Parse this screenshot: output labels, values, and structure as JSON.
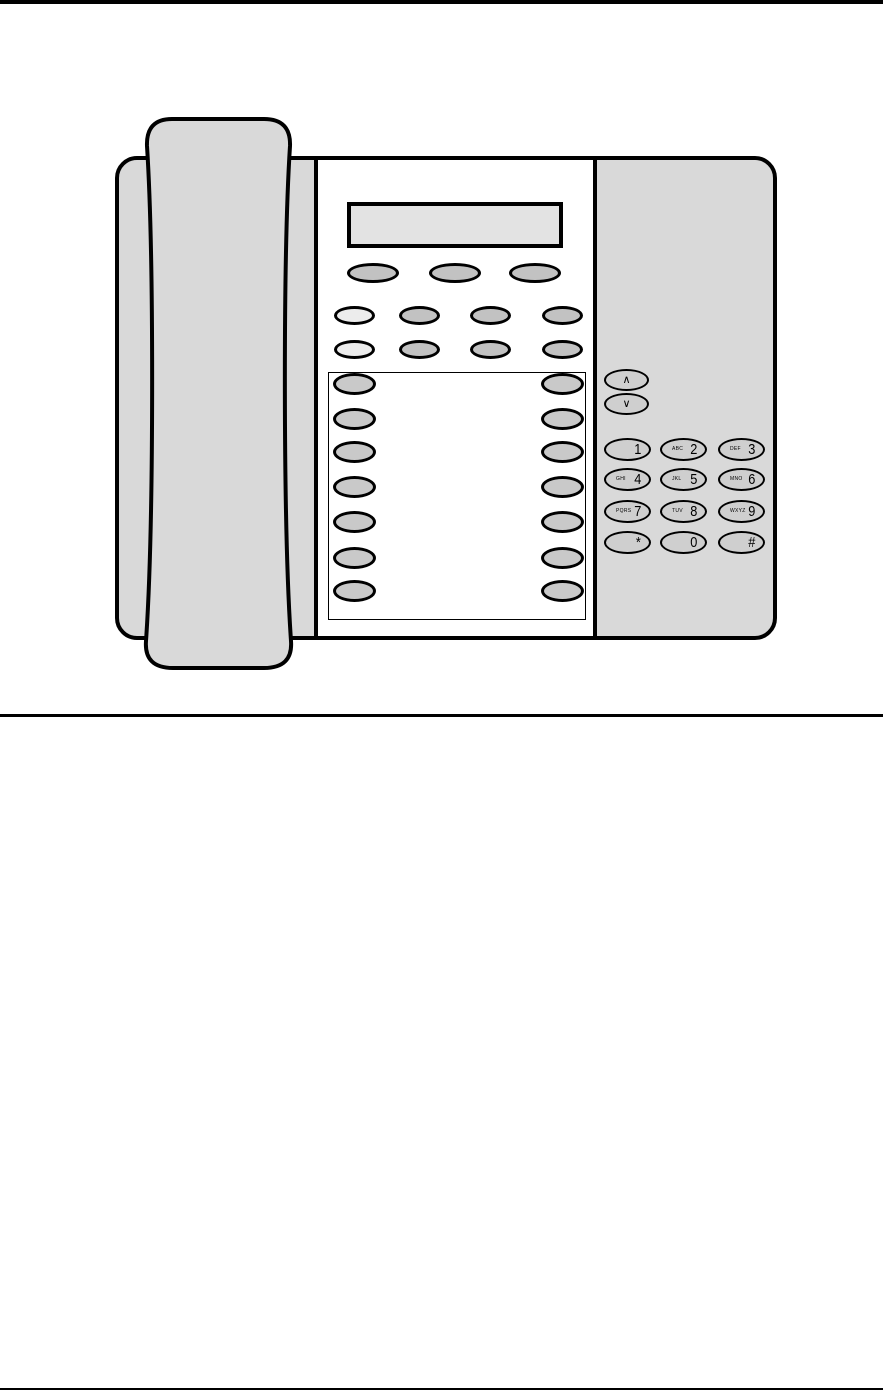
{
  "figure": {
    "nav_keys": {
      "up": "∧",
      "down": "∨"
    },
    "keypad_keys": [
      {
        "letters": "",
        "symbol": "1"
      },
      {
        "letters": "ABC",
        "symbol": "2"
      },
      {
        "letters": "DEF",
        "symbol": "3"
      },
      {
        "letters": "GHI",
        "symbol": "4"
      },
      {
        "letters": "JKL",
        "symbol": "5"
      },
      {
        "letters": "MNO",
        "symbol": "6"
      },
      {
        "letters": "PQRS",
        "symbol": "7"
      },
      {
        "letters": "TUV",
        "symbol": "8"
      },
      {
        "letters": "WXYZ",
        "symbol": "9"
      },
      {
        "letters": "",
        "symbol": "*"
      },
      {
        "letters": "",
        "symbol": "0"
      },
      {
        "letters": "",
        "symbol": "#"
      }
    ],
    "colors": {
      "body_fill": "#d9d9d9",
      "panel_fill": "#ffffff",
      "display_fill": "#e3e3e3",
      "key_gray": "#c2c2c2",
      "key_light": "#ececec",
      "prog_key_fill": "#c9c9c9",
      "keypad_fill": "#cfcfcf",
      "outline": "#000000"
    }
  }
}
